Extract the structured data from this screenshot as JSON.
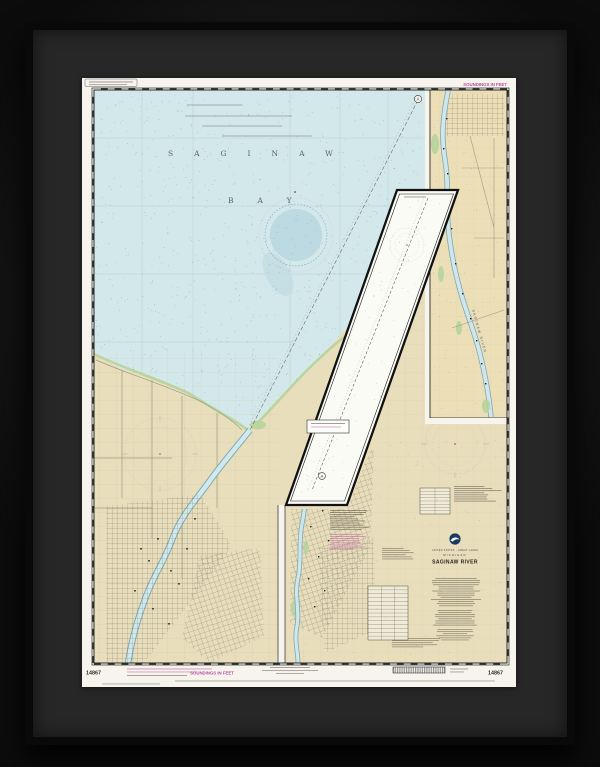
{
  "artwork": {
    "kind": "framed nautical chart print",
    "background_color": "#1d1d1d",
    "frame_color": "#262626",
    "paper_color": "#f6f4ec"
  },
  "chart": {
    "number": "14867",
    "water_color": "#d3e8ea",
    "land_color": "#e9debc",
    "accent_magenta": "#b84d9f",
    "margins": {
      "soundings_top": "SOUNDINGS IN FEET",
      "soundings_bottom": "SOUNDINGS IN FEET",
      "number_bottom_left": "14867",
      "number_bottom_right": "14867"
    },
    "bay_labels": {
      "word1": "SAGINAW",
      "word2": "BAY"
    },
    "river_label": "SAGINAW RIVER",
    "channel_marker": "A",
    "title_block": {
      "region": "UNITED STATES - GREAT LAKES",
      "state": "MICHIGAN",
      "title": "SAGINAW RIVER"
    }
  }
}
